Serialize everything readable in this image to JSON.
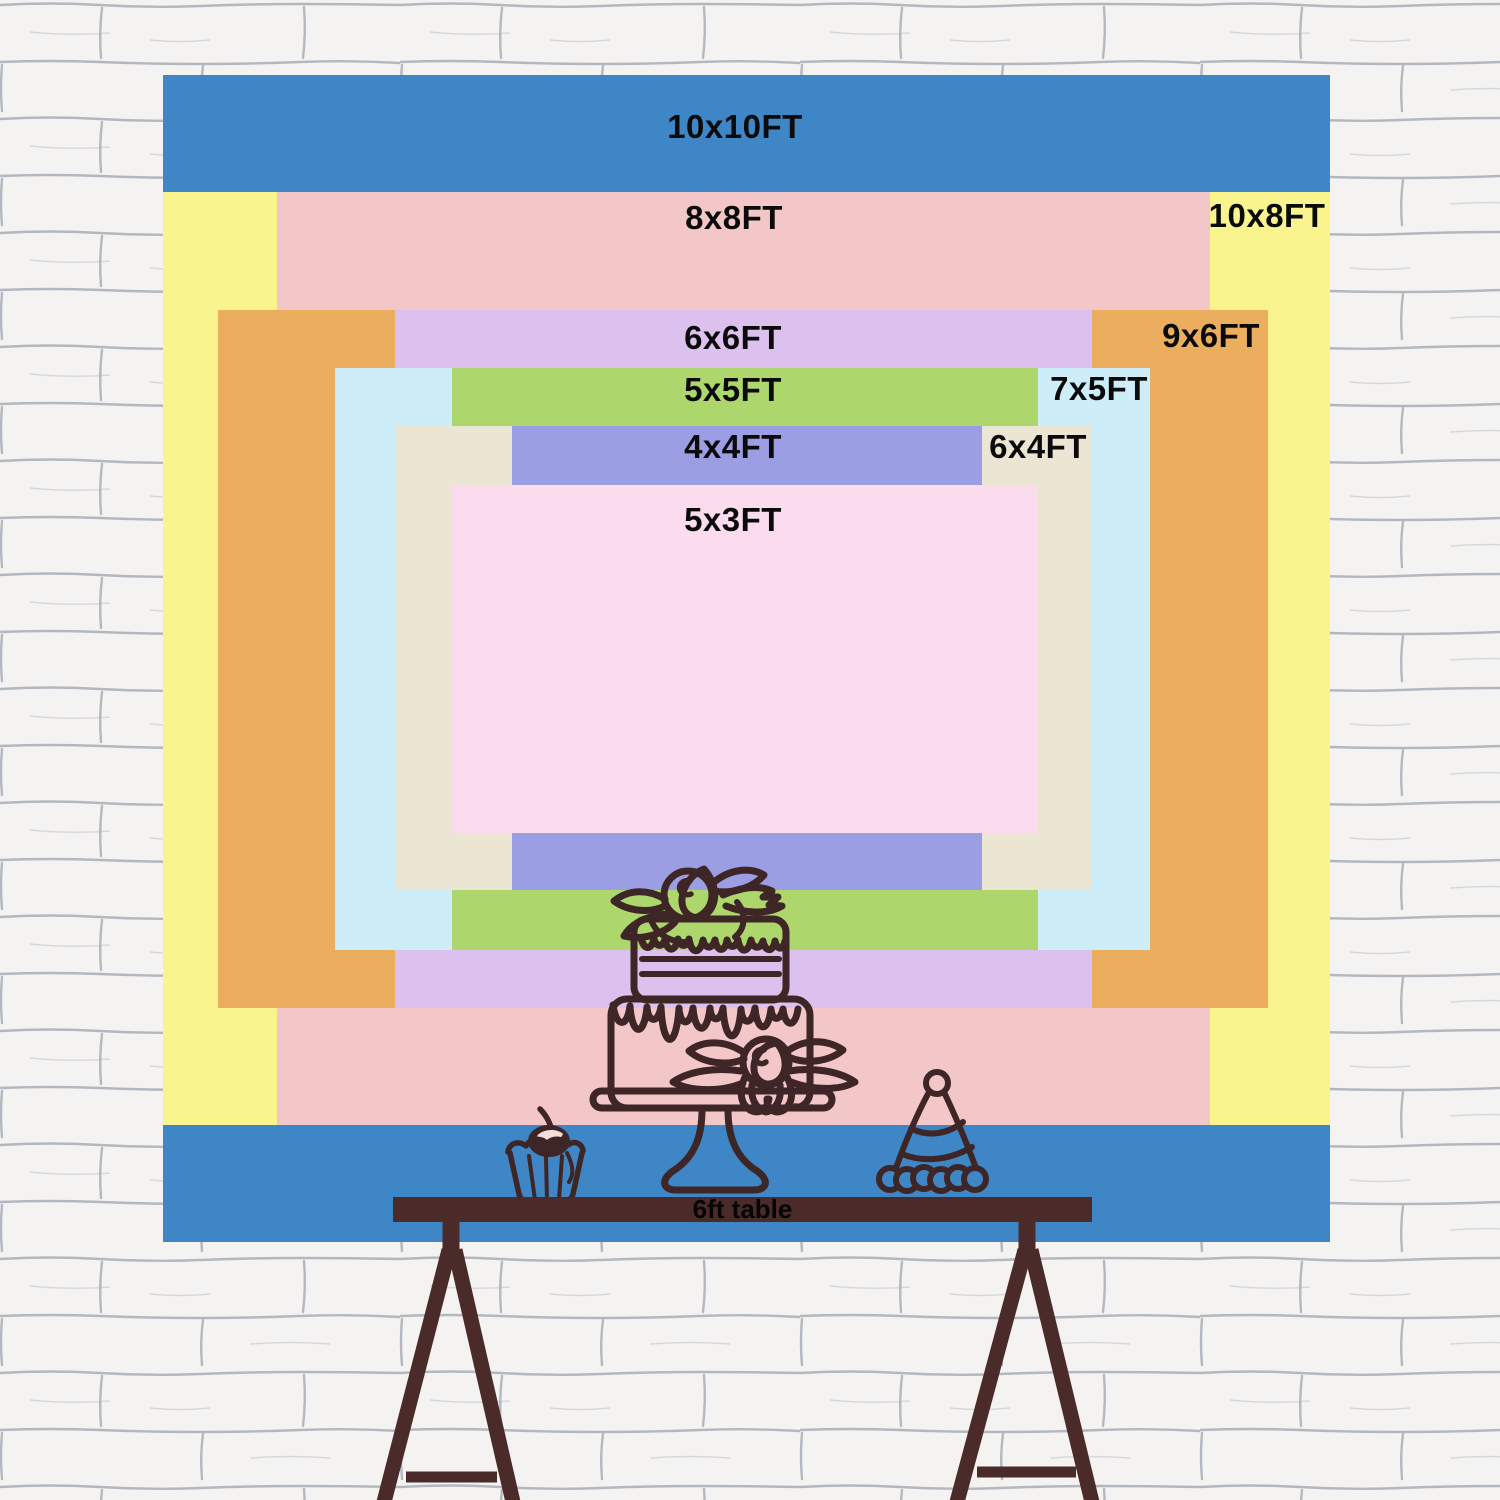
{
  "backdrop": {
    "sizes": [
      {
        "id": "10x10",
        "label": "10x10FT",
        "color": "#3E86C6"
      },
      {
        "id": "10x8",
        "label": "10x8FT",
        "color": "#FAF48F"
      },
      {
        "id": "8x8",
        "label": "8x8FT",
        "color": "#F3C7C8"
      },
      {
        "id": "9x6",
        "label": "9x6FT",
        "color": "#EBAE5F"
      },
      {
        "id": "6x6",
        "label": "6x6FT",
        "color": "#DCC0EE"
      },
      {
        "id": "7x5",
        "label": "7x5FT",
        "color": "#CDEEF8"
      },
      {
        "id": "5x5",
        "label": "5x5FT",
        "color": "#ADD76C"
      },
      {
        "id": "6x4",
        "label": "6x4FT",
        "color": "#EBE5D3"
      },
      {
        "id": "4x4",
        "label": "4x4FT",
        "color": "#9C9EE4"
      },
      {
        "id": "5x3",
        "label": "5x3FT",
        "color": "#FBDCEE"
      }
    ],
    "table": {
      "label": "6ft table",
      "color": "#4A2B29"
    },
    "art": {
      "line_color": "#3E2526",
      "cherry_fill": "#3E2526",
      "cherry_highlight": "#F2DEDC",
      "garland_fill": "#3E86C6"
    },
    "wall": {
      "base": "#F4F3F1",
      "mortar": "#7E8796"
    },
    "label_text_color": "#0B0B0B"
  }
}
